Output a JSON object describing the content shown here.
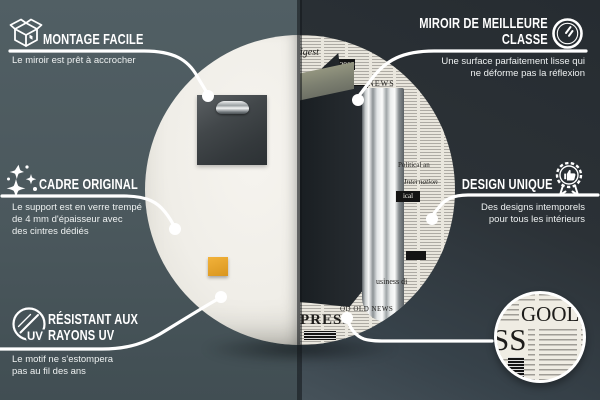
{
  "callouts": {
    "montage_facile": {
      "icon": "box-icon",
      "title": "MONTAGE FACILE",
      "subtitle": "Le miroir est prêt à accrocher"
    },
    "meilleure_classe": {
      "icon": "mirror-icon",
      "title_lines": [
        "MIROIR DE MEILLEURE",
        "CLASSE"
      ],
      "subtitle_lines": [
        "Une surface parfaitement lisse qui",
        "ne déforme pas la réflexion"
      ]
    },
    "cadre_original": {
      "icon": "sparkles-icon",
      "title": "CADRE ORIGINAL",
      "subtitle_lines": [
        "Le support est en verre trempé",
        "de 4 mm d'épaisseur avec",
        "des cintres dédiés"
      ]
    },
    "design_unique": {
      "icon": "award-icon",
      "title": "DESIGN UNIQUE",
      "subtitle_lines": [
        "Des designs intemporels",
        "pour tous les intérieurs"
      ]
    },
    "resistant_uv": {
      "icon": "uv-icon",
      "title_lines": [
        "RÉSISTANT AUX",
        "RAYONS UV"
      ],
      "subtitle_lines": [
        "Le motif ne s'estompera",
        "pas au fil des ans"
      ]
    }
  },
  "mirror": {
    "newsprint": {
      "digest": "digest",
      "year": "2019",
      "news": "NEWS",
      "inter": "Inter",
      "political": "Political an",
      "international": "Internation",
      "ical": "ical",
      "business": "usiness di",
      "good_old": "OD OLD NEWS",
      "press": "PRESS"
    }
  },
  "detail_circle": {
    "word_top": "GOOL",
    "word_left": "SS"
  },
  "colors": {
    "left_background": "#4b585d",
    "right_background": "#2b3136",
    "accent_sticker": "#e3a22b",
    "callout_line": "#ffffff",
    "newsprint_paper": "#e9e6dd"
  }
}
